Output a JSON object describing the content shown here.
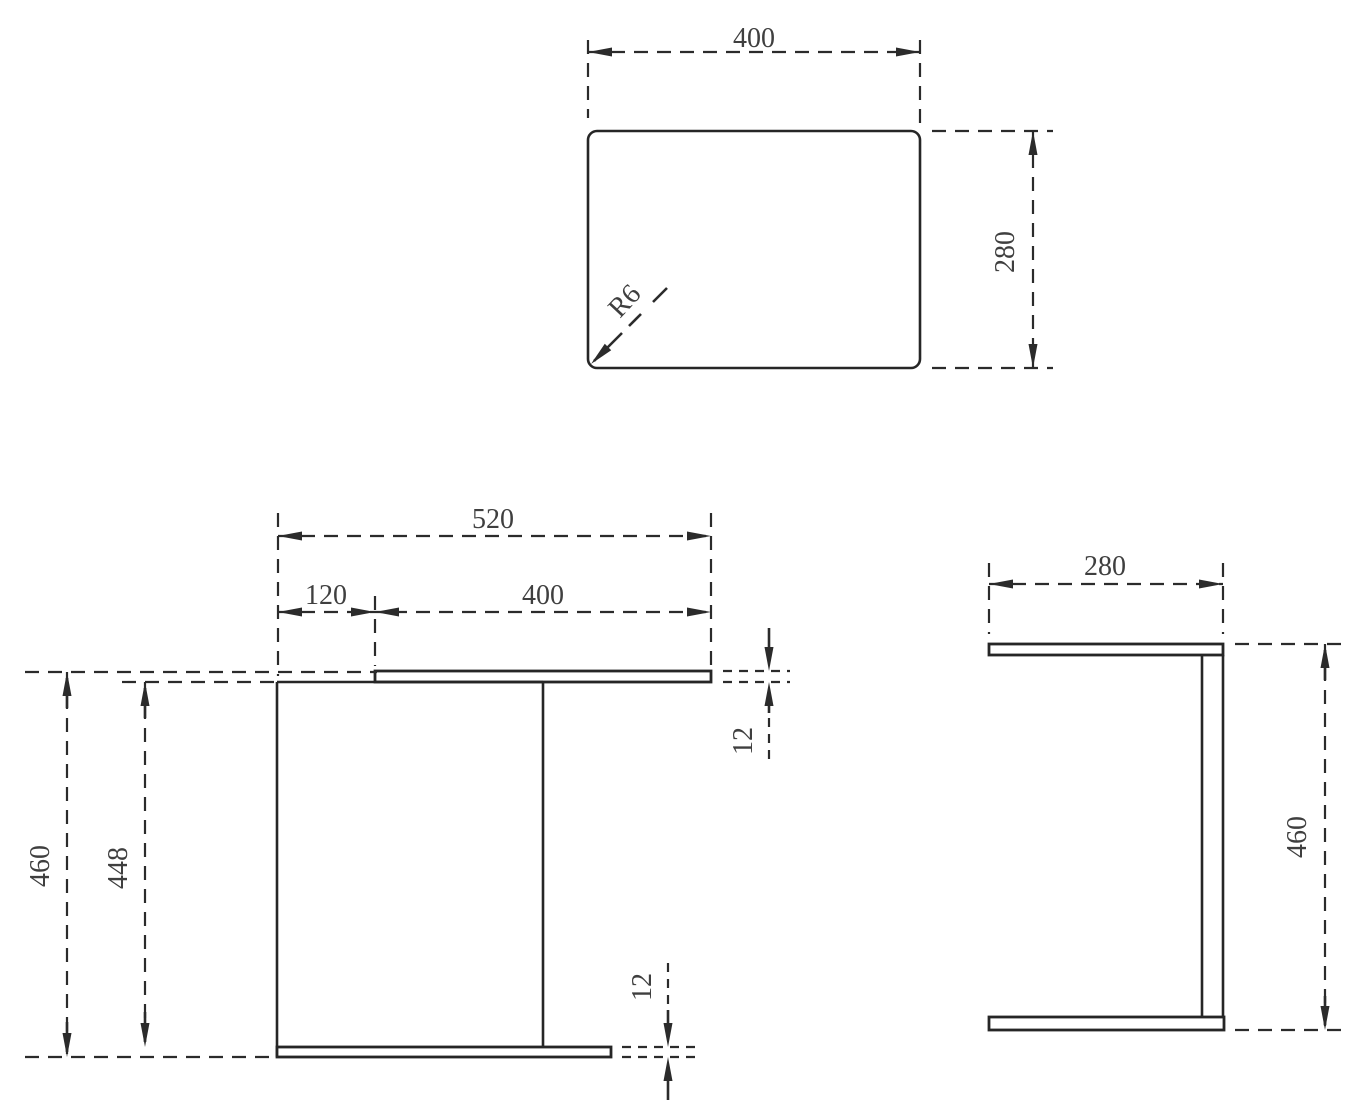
{
  "drawing": {
    "type": "furniture technical drawing, three orthographic views",
    "colors": {
      "line": "#262626",
      "dim_line": "#2b2b2b",
      "label_text": "#3f3f3f",
      "background": "#ffffff"
    },
    "top_view": {
      "width": "400",
      "depth": "280",
      "corner_radius": "R6"
    },
    "front_view": {
      "overall_width": "520",
      "top_offset": "120",
      "top_width": "400",
      "overall_height": "460",
      "inner_height": "448",
      "top_thickness": "12",
      "bottom_thickness": "12"
    },
    "side_view": {
      "depth": "280",
      "overall_height": "460"
    }
  }
}
